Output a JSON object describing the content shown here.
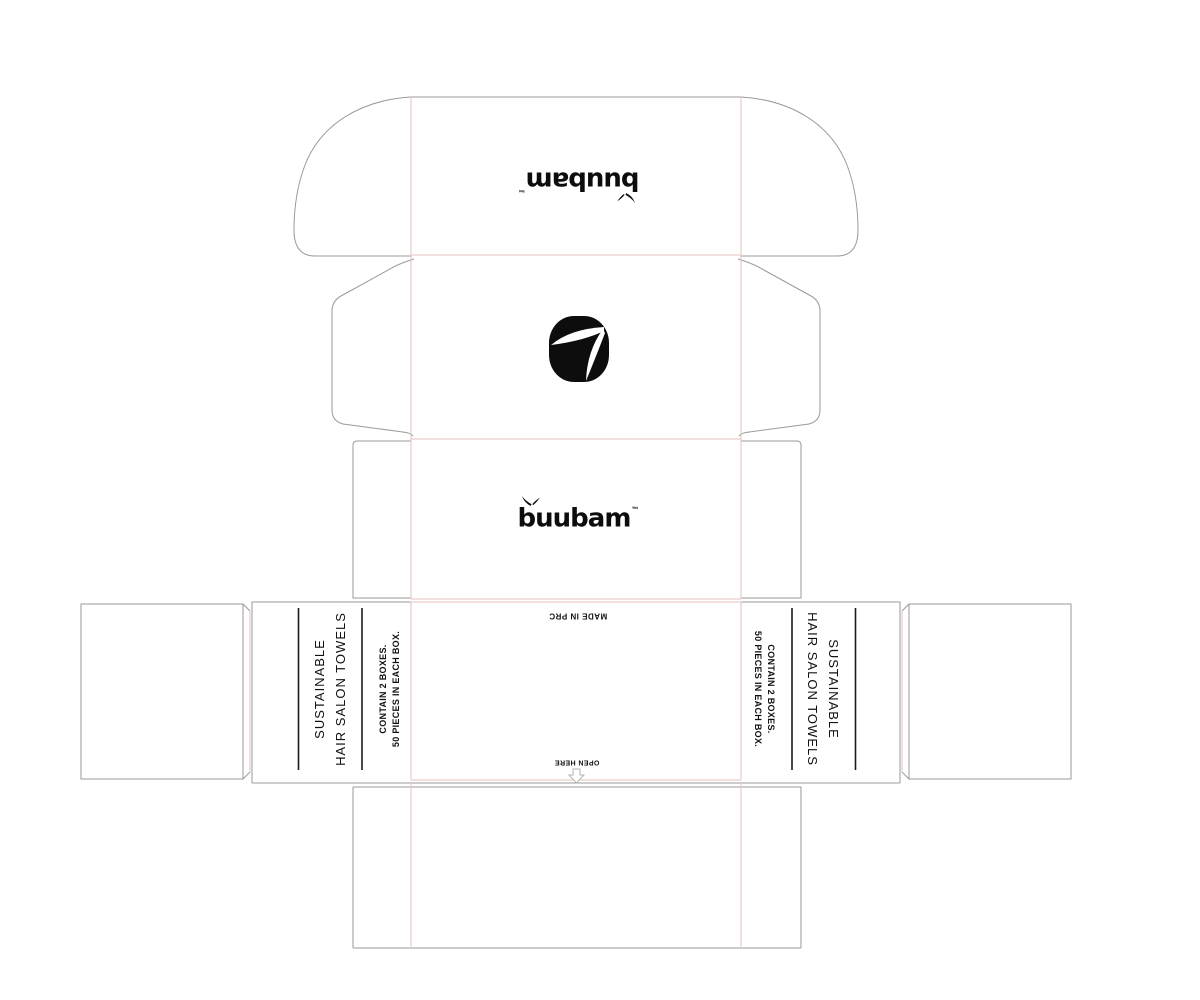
{
  "brand": {
    "wordmark": "buubam",
    "trademark_symbol": "™",
    "sprig_icon": "bamboo-sprig-icon",
    "squircle_icon": "bamboo-leaves-squircle-icon"
  },
  "side_panel": {
    "title_line1": "SUSTAINABLE",
    "title_line2": "HAIR SALON TOWELS",
    "contents_line1": "CONTAIN 2 BOXES.",
    "contents_line2": "50 PIECES IN EACH BOX."
  },
  "center_panel": {
    "made_in": "MADE IN PRC",
    "open_here": "OPEN HERE",
    "open_arrow_icon": "open-here-arrow-icon"
  },
  "dieline_colors": {
    "cut_line": "#9a9a9a",
    "fold_line": "#eabfbf",
    "ink": "#111111",
    "background": "#ffffff"
  }
}
